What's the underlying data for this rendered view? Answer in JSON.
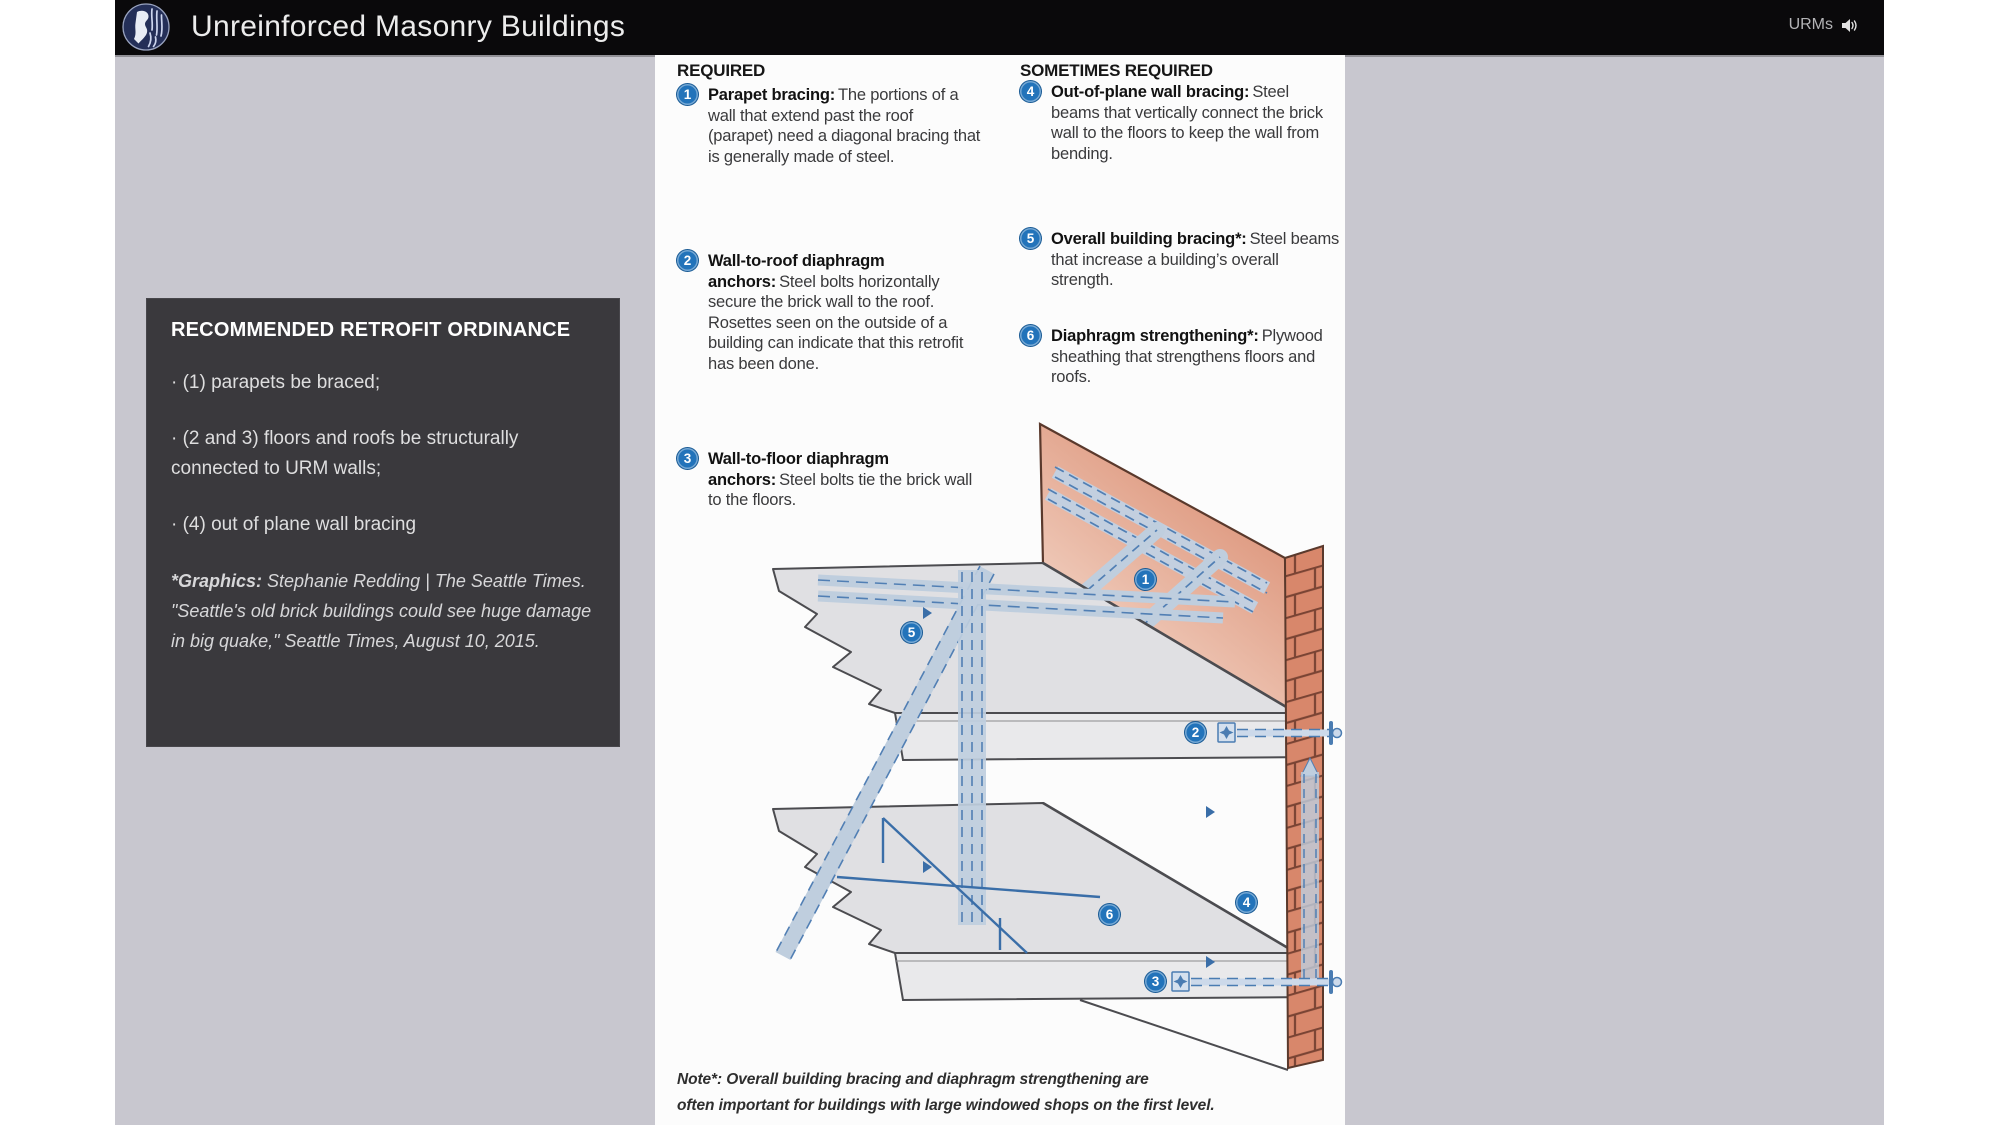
{
  "header": {
    "title": "Unreinforced Masonry Buildings",
    "nav_label": "URMs",
    "logo_name": "seattle-city-seal",
    "bg_color": "#0a090b"
  },
  "info_box": {
    "heading": "RECOMMENDED RETROFIT ORDINANCE",
    "bullets": [
      "· (1) parapets be braced;",
      "· (2 and 3) floors and roofs be structurally connected to URM walls;",
      "· (4) out of plane wall bracing"
    ],
    "credit_lead": "*Graphics:",
    "credit_text": " Stephanie Redding | The Seattle Times. \"Seattle's old brick buildings could see huge damage in big quake,\" Seattle Times, August 10, 2015."
  },
  "diagram": {
    "required_heading": "REQUIRED",
    "sometimes_heading": "SOMETIMES REQUIRED",
    "items": [
      {
        "num": "1",
        "title": "Parapet bracing:",
        "body": "The portions of a wall that extend past the roof (parapet) need a diagonal bracing that is generally made of steel."
      },
      {
        "num": "2",
        "title": "Wall-to-roof diaphragm anchors:",
        "body": "Steel bolts horizontally secure the brick wall to the roof. Rosettes seen on the outside of a building can indicate that this retrofit has been done."
      },
      {
        "num": "3",
        "title": "Wall-to-floor diaphragm anchors:",
        "body": "Steel bolts tie the brick wall to the floors."
      },
      {
        "num": "4",
        "title": "Out-of-plane wall bracing:",
        "body": "Steel beams that vertically connect the brick wall to the floors to keep the wall from bending."
      },
      {
        "num": "5",
        "title": "Overall building bracing*:",
        "body": "Steel beams that increase a building’s overall strength."
      },
      {
        "num": "6",
        "title": "Diaphragm strengthening*:",
        "body": "Plywood sheathing that strengthens floors and roofs."
      }
    ],
    "note_line1": "Note*: Overall building bracing and diaphragm strengthening are",
    "note_line2": "often important for buildings with large windowed shops on the first level.",
    "colors": {
      "callout_blue": "#2273ba",
      "steel_fill": "#bfcede",
      "steel_dash": "#517fb4",
      "brick": "#d8876b",
      "mortar": "#7a4434",
      "deck": "#e0e0e3"
    }
  }
}
